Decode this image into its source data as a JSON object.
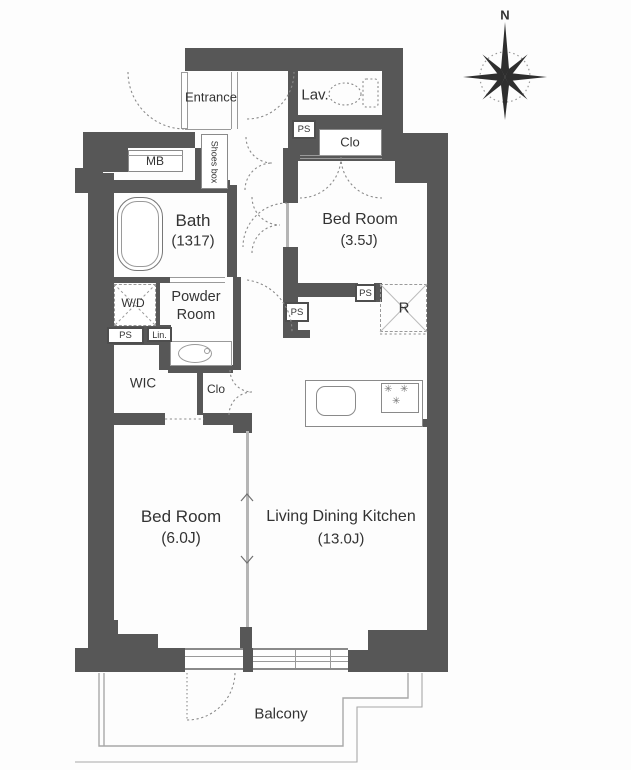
{
  "type": "apartment-floor-plan",
  "compass": {
    "north": "N"
  },
  "rooms": {
    "entrance": {
      "label": "Entrance"
    },
    "shoes_box": {
      "label": "Shoes box"
    },
    "lavatory": {
      "label": "Lav."
    },
    "meter_box": {
      "label": "MB"
    },
    "bath": {
      "label": "Bath",
      "size": "(1317)"
    },
    "bedroom_3_5": {
      "label": "Bed Room",
      "size": "(3.5J)"
    },
    "closet_upper": {
      "label": "Clo"
    },
    "washer_dryer": {
      "label": "W/D"
    },
    "powder_room": {
      "line1": "Powder",
      "line2": "Room"
    },
    "linen": {
      "label": "Lin."
    },
    "pipe_space": {
      "label": "PS"
    },
    "wic": {
      "label": "WIC"
    },
    "closet_lower": {
      "label": "Clo"
    },
    "refrigerator_space": {
      "label": "R"
    },
    "bedroom_6_0": {
      "label": "Bed Room",
      "size": "(6.0J)"
    },
    "ldk": {
      "label": "Living Dining Kitchen",
      "size": "(13.0J)"
    },
    "balcony": {
      "label": "Balcony"
    }
  },
  "colors": {
    "wall": "#575757",
    "outline": "#8a8a8a",
    "text": "#333333",
    "balcony_line": "#a8a8a8",
    "partition": "#b5b5b5"
  }
}
